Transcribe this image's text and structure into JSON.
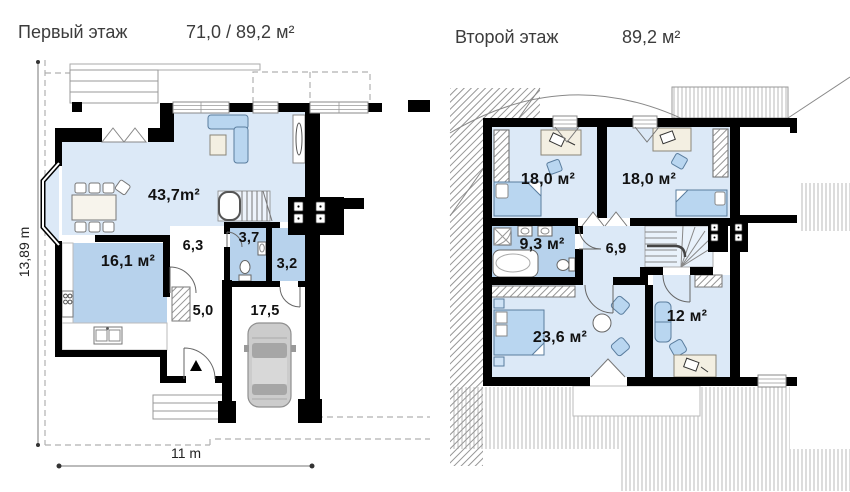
{
  "header": {
    "floor1": {
      "title": "Первый этаж",
      "area": "71,0 / 89,2 м²"
    },
    "floor2": {
      "title": "Второй этаж",
      "area": "89,2 м²"
    }
  },
  "floor1": {
    "rooms": {
      "living": "43,7m²",
      "kitchen": "16,1 м²",
      "hall": "6,3",
      "bathroom": "3,7",
      "pantry": "3,2",
      "entry": "5,0",
      "garage": "17,5"
    },
    "dimensions": {
      "height": "13,89 m",
      "width": "11 m"
    }
  },
  "floor2": {
    "rooms": {
      "bedroom1": "18,0 м²",
      "bedroom2": "18,0 м²",
      "bathroom": "9,3 м²",
      "hall": "6,9",
      "bedroom3": "23,6 м²",
      "study": "12 м²"
    }
  },
  "colors": {
    "wall": "#000000",
    "room_fill": "#dce9f7",
    "wet_room_fill": "#b7d2ec",
    "furniture_blue": "#b9d6f0",
    "furniture_beige": "#f3efe2",
    "hatch": "#9a9a9a",
    "dashed_outline": "#b0b0b0",
    "label_text": "#111111",
    "header_text": "#3c3c3c"
  }
}
